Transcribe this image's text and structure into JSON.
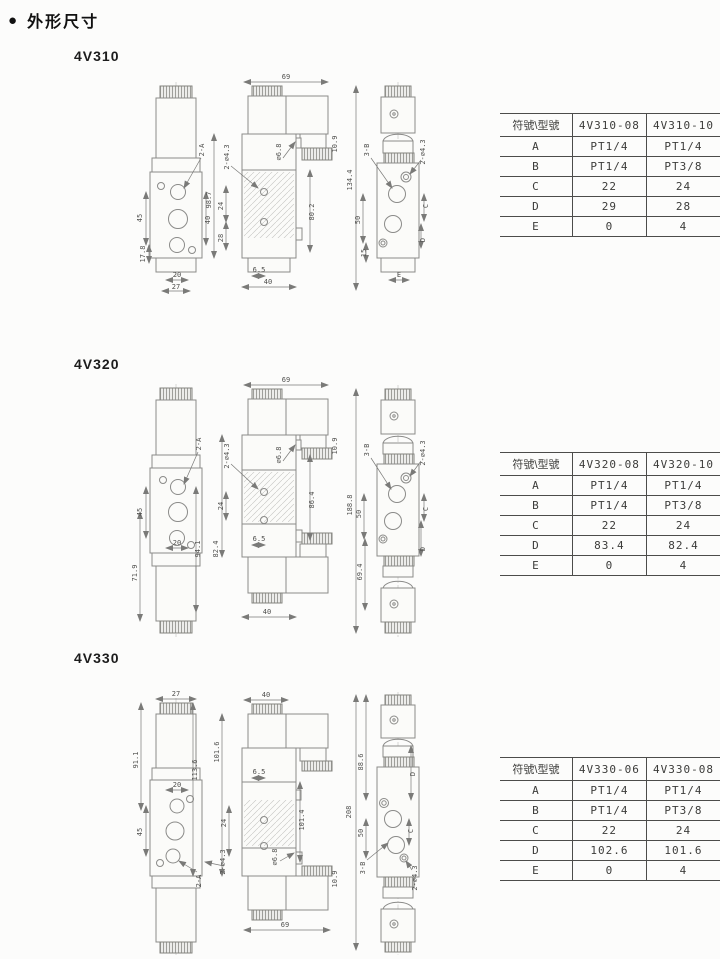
{
  "page": {
    "bullet": "●",
    "title": "外形尺寸"
  },
  "sections": [
    {
      "label": "4V310",
      "table": {
        "header": [
          "符號\\型號",
          "4V310-08",
          "4V310-10"
        ],
        "rows": [
          [
            "A",
            "PT1/4",
            "PT1/4"
          ],
          [
            "B",
            "PT1/4",
            "PT3/8"
          ],
          [
            "C",
            "22",
            "24"
          ],
          [
            "D",
            "29",
            "28"
          ],
          [
            "E",
            "0",
            "4"
          ]
        ]
      },
      "views": {
        "front": {
          "port_a": "2-A",
          "h_ports": "45",
          "h_low": "17.8",
          "w_inner": "20",
          "w_outer": "27",
          "h_right": "40"
        },
        "side": {
          "w_top": "69",
          "holes": "2-∅4.3",
          "h_total": "98.7",
          "h_mid": "24",
          "h_low": "28",
          "bore": "∅6.8",
          "conn": "10.9",
          "len": "80.2",
          "b_inner": "6.5",
          "b_outer": "40"
        },
        "front2": {
          "h_total": "134.4",
          "port_b": "3-B",
          "holes": "2-∅4.3",
          "h_ports": "50",
          "h_low": "15",
          "dim_c": "C",
          "dim_d": "D",
          "dim_e": "E"
        }
      }
    },
    {
      "label": "4V320",
      "table": {
        "header": [
          "符號\\型號",
          "4V320-08",
          "4V320-10"
        ],
        "rows": [
          [
            "A",
            "PT1/4",
            "PT1/4"
          ],
          [
            "B",
            "PT1/4",
            "PT3/8"
          ],
          [
            "C",
            "22",
            "24"
          ],
          [
            "D",
            "83.4",
            "82.4"
          ],
          [
            "E",
            "0",
            "4"
          ]
        ]
      },
      "views": {
        "front": {
          "port_a": "2-A",
          "h_ports": "45",
          "h_low": "71.9",
          "w_inner": "20",
          "h_right": "94.1"
        },
        "side": {
          "w_top": "69",
          "holes": "2-∅4.3",
          "h_mid": "24",
          "h_low": "82.4",
          "bore": "∅6.8",
          "conn": "10.9",
          "len": "86.4",
          "b_inner": "6.5",
          "b_outer": "40"
        },
        "front2": {
          "h_total": "188.8",
          "port_b": "3-B",
          "holes": "2-∅4.3",
          "h_ports": "50",
          "h_low": "69.4",
          "dim_c": "C",
          "dim_d": "D"
        }
      }
    },
    {
      "label": "4V330",
      "table": {
        "header": [
          "符號\\型號",
          "4V330-06",
          "4V330-08"
        ],
        "rows": [
          [
            "A",
            "PT1/4",
            "PT1/4"
          ],
          [
            "B",
            "PT1/4",
            "PT3/8"
          ],
          [
            "C",
            "22",
            "24"
          ],
          [
            "D",
            "102.6",
            "101.6"
          ],
          [
            "E",
            "0",
            "4"
          ]
        ]
      },
      "views": {
        "front": {
          "w_top": "27",
          "port_a": "2-A",
          "h_left": "91.1",
          "h_ports": "45",
          "w_inner": "20",
          "h_inner": "113.6"
        },
        "side": {
          "w_top": "40",
          "h_left": "101.6",
          "h_mid": "24",
          "holes": "2-∅4.3",
          "b_inner": "6.5",
          "len": "101.4",
          "bore": "∅6.8",
          "conn": "10.9",
          "b_outer": "69"
        },
        "front2": {
          "h_total": "208",
          "h_top": "88.6",
          "h_ports": "50",
          "dim_c": "C",
          "dim_d": "D",
          "port_b": "3-B",
          "holes": "2-∅4.3"
        }
      }
    }
  ]
}
